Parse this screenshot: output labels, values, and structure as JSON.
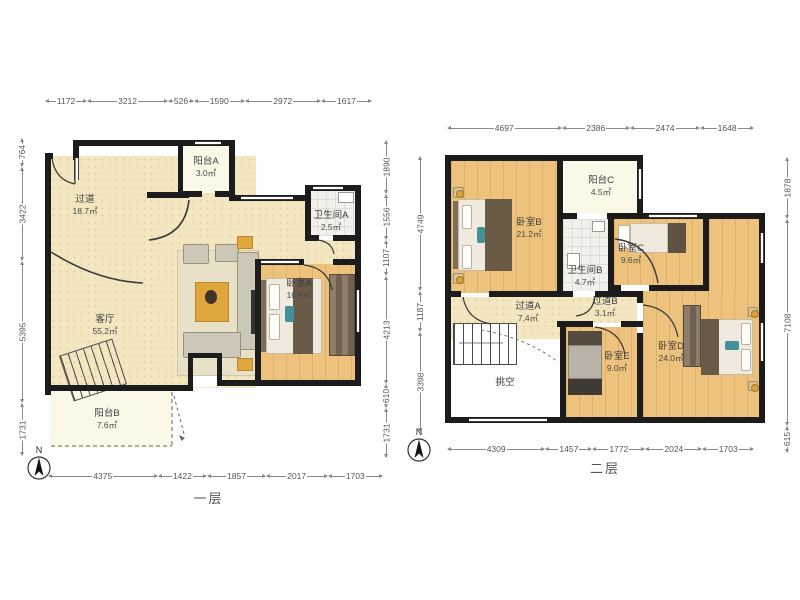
{
  "colors": {
    "wall": "#1c1c1c",
    "floor_cream": "#f3e7c1",
    "floor_wood": "#ecc27c",
    "floor_pale": "#fbf8e8",
    "accent_gold": "#dfa63e",
    "accent_teal": "#44909a",
    "dim_text": "#555555"
  },
  "plans": [
    {
      "title": "一层",
      "north": "N",
      "dims_top": [
        "1172",
        "3212",
        "526",
        "1590",
        "2972",
        "1617"
      ],
      "dims_bottom": [
        "4375",
        "1422",
        "1857",
        "2017",
        "1703"
      ],
      "dims_left": [
        "764",
        "3422",
        "5395",
        "1731"
      ],
      "dims_right": [
        "1890",
        "1556",
        "1107",
        "4213",
        "610",
        "1731"
      ],
      "rooms": {
        "hallway": {
          "name": "过道",
          "area": "18.7㎡"
        },
        "balconyA": {
          "name": "阳台A",
          "area": "3.0㎡"
        },
        "bathA": {
          "name": "卫生间A",
          "area": "2.5㎡"
        },
        "living": {
          "name": "客厅",
          "area": "55.2㎡"
        },
        "bedA": {
          "name": "卧室A",
          "area": "16.9㎡"
        },
        "balconyB": {
          "name": "阳台B",
          "area": "7.6㎡"
        }
      }
    },
    {
      "title": "二层",
      "north": "N",
      "dims_top": [
        "4697",
        "2386",
        "2474",
        "1648"
      ],
      "dims_bottom": [
        "4309",
        "1457",
        "1772",
        "2024",
        "1703"
      ],
      "dims_left": [
        "4749",
        "1187",
        "3398"
      ],
      "dims_right": [
        "1878",
        "7108",
        "615"
      ],
      "rooms": {
        "bedB": {
          "name": "卧室B",
          "area": "21.2㎡"
        },
        "balconyC": {
          "name": "阳台C",
          "area": "4.5㎡"
        },
        "bathB": {
          "name": "卫生间B",
          "area": "4.7㎡"
        },
        "bedC": {
          "name": "卧室C",
          "area": "9.6㎡"
        },
        "hallA": {
          "name": "过道A",
          "area": "7.4㎡"
        },
        "hallB": {
          "name": "过道B",
          "area": "3.1㎡"
        },
        "void": {
          "name": "挑空",
          "area": ""
        },
        "bedE": {
          "name": "卧室E",
          "area": "9.0㎡"
        },
        "bedD": {
          "name": "卧室D",
          "area": "24.0㎡"
        }
      }
    }
  ]
}
